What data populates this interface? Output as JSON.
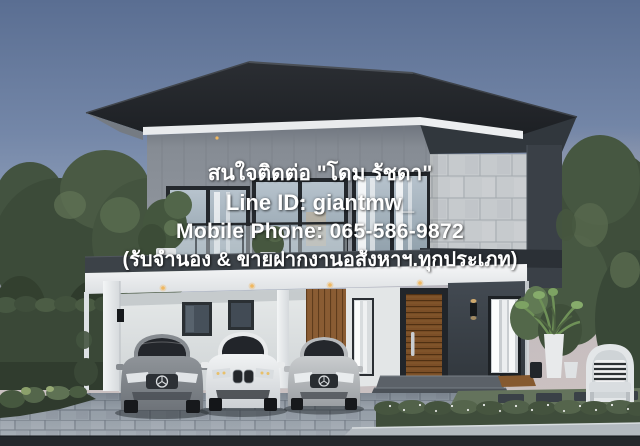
{
  "alt": "Dusk 3D rendering of a modern two-storey house with dark hip roof, stone-clad wing, glass balcony, carport with three cars and landscaped garden, overlaid with a Thai real-estate contact watermark",
  "watermark": {
    "line1": "สนใจติดต่อ \"โดม รัชดา\"",
    "line2": "Line ID: giantmw_",
    "line3": "Mobile Phone: 065-586-9872",
    "line4": "(รับจำนอง & ขายฝากงานอสังหาฯ.ทุกประเภท)"
  },
  "colors": {
    "watermark_text": "#ffffff",
    "sky_top": "#5a6e92",
    "sky_horizon": "#d9c7bd",
    "roof": "#23262a",
    "wall_panel": "#8d939a",
    "stone": "#c6cacd",
    "charcoal_wall": "#3a4047",
    "fascia_white": "#f4f5f6",
    "door_wood": "#7c4f27",
    "foliage": "#44543f",
    "paver": "#9aa3ac",
    "road": "#24282c"
  }
}
